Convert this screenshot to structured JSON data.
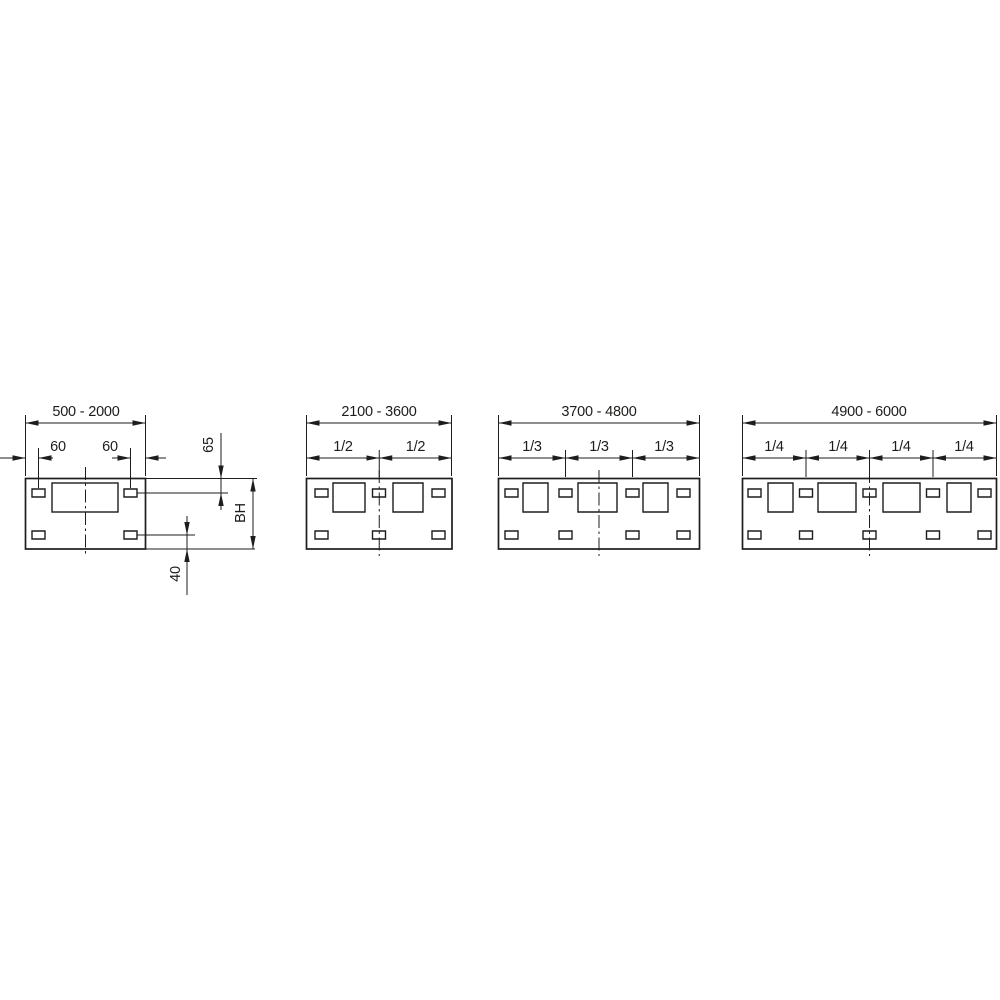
{
  "drawing": {
    "diagrams": [
      {
        "range": "500 - 2000",
        "labels": {
          "left": "60",
          "right": "60",
          "top": "65",
          "height": "BH",
          "bottom": "40"
        }
      },
      {
        "range": "2100 - 3600",
        "fractions": [
          "1/2",
          "1/2"
        ]
      },
      {
        "range": "3700 - 4800",
        "fractions": [
          "1/3",
          "1/3",
          "1/3"
        ]
      },
      {
        "range": "4900 - 6000",
        "fractions": [
          "1/4",
          "1/4",
          "1/4",
          "1/4"
        ]
      }
    ],
    "colors": {
      "line": "#1d1d1b",
      "background": "#ffffff"
    }
  }
}
